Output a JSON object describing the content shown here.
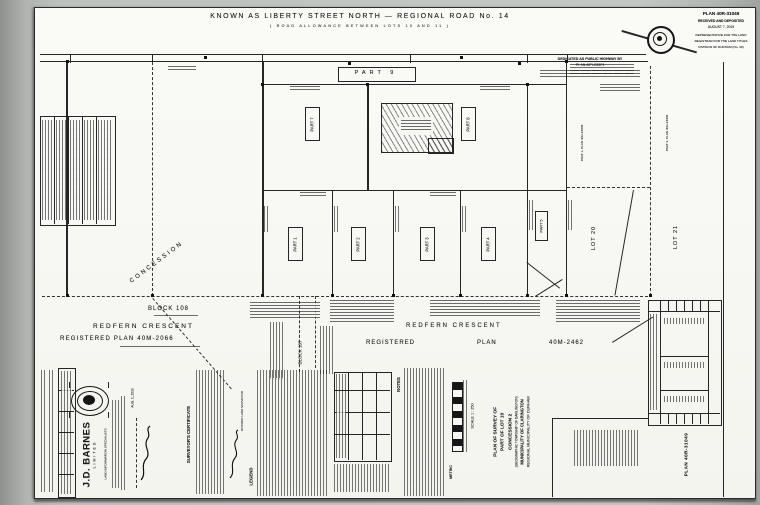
{
  "colors": {
    "bg": "#b0b2af",
    "paper": "#f7f7f3",
    "ink": "#222222"
  },
  "header": {
    "road_title": "KNOWN  AS  LIBERTY  STREET  NORTH  —  REGIONAL  ROAD  No. 14",
    "road_subtitle": "( ROAD   ALLOWANCE   BETWEEN   LOTS   10   AND   11 )"
  },
  "stamp": {
    "line1": "PLAN 40R-31049",
    "line2": "RECEIVED AND DEPOSITED",
    "line3": "AUGUST 7, 2019",
    "line4": "REPRESENTATIVE FOR THE LAND",
    "line5": "REGISTRAR FOR THE LAND TITLES",
    "line6": "DIVISION OF DURHAM (No. 40)"
  },
  "dedication": {
    "line1": "DEDICATED AS PUBLIC HIGHWAY BY",
    "line2": "PLAN 40R-23308"
  },
  "parts": {
    "p1": "PART 1",
    "p2": "PART 2",
    "p3": "PART 3",
    "p4": "PART 4",
    "p5": "PART 5",
    "p7": "PART 7",
    "p8": "PART 8",
    "p9": "PART 9"
  },
  "lots": {
    "lot20": "LOT 20",
    "lot21": "LOT 21"
  },
  "refs": {
    "inner": "PART 1, PLAN 40R-23308",
    "outer": "PART 2, PLAN 40R-23308",
    "concession": "CONCESSION"
  },
  "south": {
    "block108": "BLOCK 108",
    "block107": "BLOCK 107",
    "redfern_left": "REDFERN  CRESCENT",
    "plan_left": "REGISTERED   PLAN   40M-2066",
    "redfern_right": "REDFERN   CRESCENT",
    "registered": "REGISTERED",
    "plan_word": "PLAN",
    "plan_no": "40M-2462"
  },
  "titleblock": {
    "certificate": "SURVEYOR'S CERTIFICATE",
    "ols": "ONTARIO LAND SURVEYOR",
    "date": "AUG. 1, 2019",
    "legend": "LEGEND",
    "notes": "NOTES",
    "metric": "METRIC",
    "scale": "SCALE  1 : 250",
    "title1": "PLAN OF SURVEY OF",
    "title2": "PART OF LOT 10",
    "title3": "CONCESSION 2",
    "title4": "(GEOGRAPHIC TOWNSHIP OF DARLINGTON)",
    "title5": "MUNICIPALITY OF CLARINGTON",
    "title6": "REGIONAL MUNICIPALITY OF DURHAM",
    "firm": "J.D. BARNES",
    "firm_suffix": "LIMITED",
    "tagline": "LAND INFORMATION SPECIALISTS"
  },
  "planbox": {
    "plan_no": "PLAN 40R-31049"
  }
}
